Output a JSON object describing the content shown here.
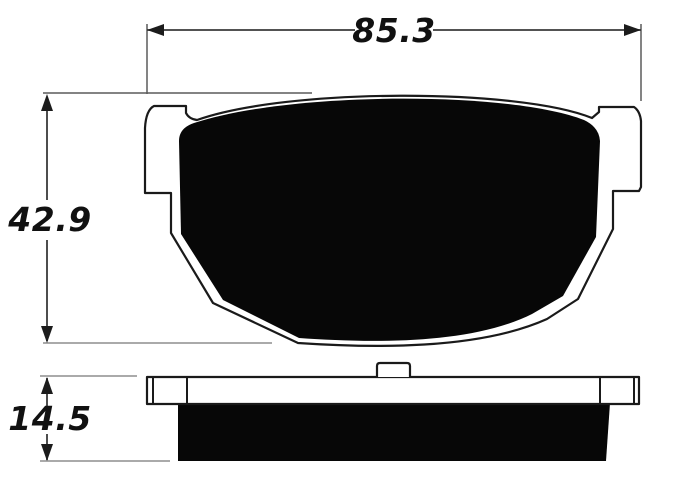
{
  "dimensions": {
    "width": "85.3",
    "height": "42.9",
    "thickness": "14.5"
  },
  "colors": {
    "line": "#1a1a1a",
    "pad_fill": "#070707",
    "plate_fill": "#ffffff",
    "extension_line": "#8d8d8d",
    "background": "#ffffff"
  }
}
